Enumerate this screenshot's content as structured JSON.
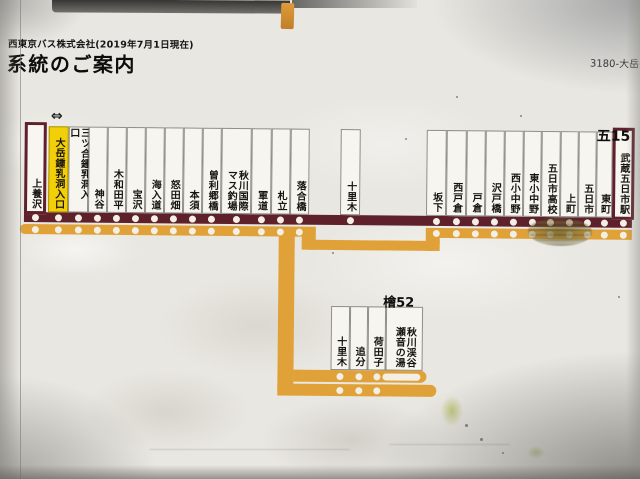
{
  "header": {
    "company": "西東京バス株式会社(2019年7月1日現在)",
    "title": "系統のご案内",
    "sign_code": "3180-大岳"
  },
  "route_map": {
    "main_route_number": "五15",
    "branch_route_number": "檜52",
    "current_stop_marker": "⇔",
    "colors": {
      "main_line": "#5e212b",
      "branch_line": "#dfa138",
      "highlight_bg": "#f2cf07",
      "stop_dot": "#f3efe5"
    },
    "main_line_stops": [
      {
        "name": "上養沢",
        "x": 24,
        "w": 22,
        "style": "terminal",
        "on_branch": true
      },
      {
        "name": "大岳鍾乳洞入口",
        "x": 48,
        "w": 20,
        "style": "highlight",
        "on_branch": true
      },
      {
        "name": "三ツ合鍾乳洞入口",
        "x": 68,
        "w": 20,
        "style": "normal",
        "on_branch": true
      },
      {
        "name": "神谷",
        "x": 88,
        "w": 19,
        "style": "normal",
        "on_branch": true
      },
      {
        "name": "木和田平",
        "x": 107,
        "w": 19,
        "style": "normal",
        "on_branch": true
      },
      {
        "name": "宝沢",
        "x": 126,
        "w": 19,
        "style": "normal",
        "on_branch": true
      },
      {
        "name": "海入道",
        "x": 145,
        "w": 19,
        "style": "normal",
        "on_branch": true
      },
      {
        "name": "怒田畑",
        "x": 164,
        "w": 19,
        "style": "normal",
        "on_branch": true
      },
      {
        "name": "本須",
        "x": 183,
        "w": 19,
        "style": "normal",
        "on_branch": true
      },
      {
        "name": "曽利郷橋",
        "x": 202,
        "w": 19,
        "style": "normal",
        "on_branch": true
      },
      {
        "name": "秋川国際\nマス釣場",
        "x": 221,
        "w": 30,
        "style": "wide",
        "on_branch": true
      },
      {
        "name": "軍道",
        "x": 251,
        "w": 20,
        "style": "normal",
        "on_branch": true
      },
      {
        "name": "札立",
        "x": 271,
        "w": 19,
        "style": "normal",
        "on_branch": true
      },
      {
        "name": "落合橋",
        "x": 290,
        "w": 19,
        "style": "normal",
        "on_branch": true
      },
      {
        "name": "十里木",
        "x": 340,
        "w": 20,
        "style": "normal",
        "on_branch": false
      },
      {
        "name": "坂下",
        "x": 426,
        "w": 20,
        "style": "normal",
        "on_branch": true
      },
      {
        "name": "西戸倉",
        "x": 446,
        "w": 20,
        "style": "normal",
        "on_branch": true
      },
      {
        "name": "戸倉",
        "x": 466,
        "w": 19,
        "style": "normal",
        "on_branch": true
      },
      {
        "name": "沢戸橋",
        "x": 485,
        "w": 19,
        "style": "normal",
        "on_branch": true
      },
      {
        "name": "西小中野",
        "x": 504,
        "w": 19,
        "style": "normal",
        "on_branch": true
      },
      {
        "name": "東小中野",
        "x": 523,
        "w": 18,
        "style": "normal",
        "on_branch": true
      },
      {
        "name": "五日市高校",
        "x": 541,
        "w": 19,
        "style": "normal",
        "on_branch": true
      },
      {
        "name": "上町",
        "x": 560,
        "w": 18,
        "style": "normal",
        "on_branch": true
      },
      {
        "name": "五日市",
        "x": 578,
        "w": 18,
        "style": "normal",
        "on_branch": true
      },
      {
        "name": "東町",
        "x": 596,
        "w": 16,
        "style": "normal",
        "on_branch": true
      },
      {
        "name": "武蔵五日市駅",
        "x": 612,
        "w": 22,
        "style": "terminal",
        "on_branch": true
      }
    ],
    "branch_stops": [
      {
        "name": "十里木",
        "x": 332,
        "w": 19,
        "terminal_dash": false
      },
      {
        "name": "追分",
        "x": 351,
        "w": 18,
        "terminal_dash": false
      },
      {
        "name": "荷田子",
        "x": 369,
        "w": 18,
        "terminal_dash": false
      },
      {
        "name": "秋川渓谷\n瀬音の湯",
        "x": 387,
        "w": 37,
        "terminal_dash": true
      }
    ]
  }
}
